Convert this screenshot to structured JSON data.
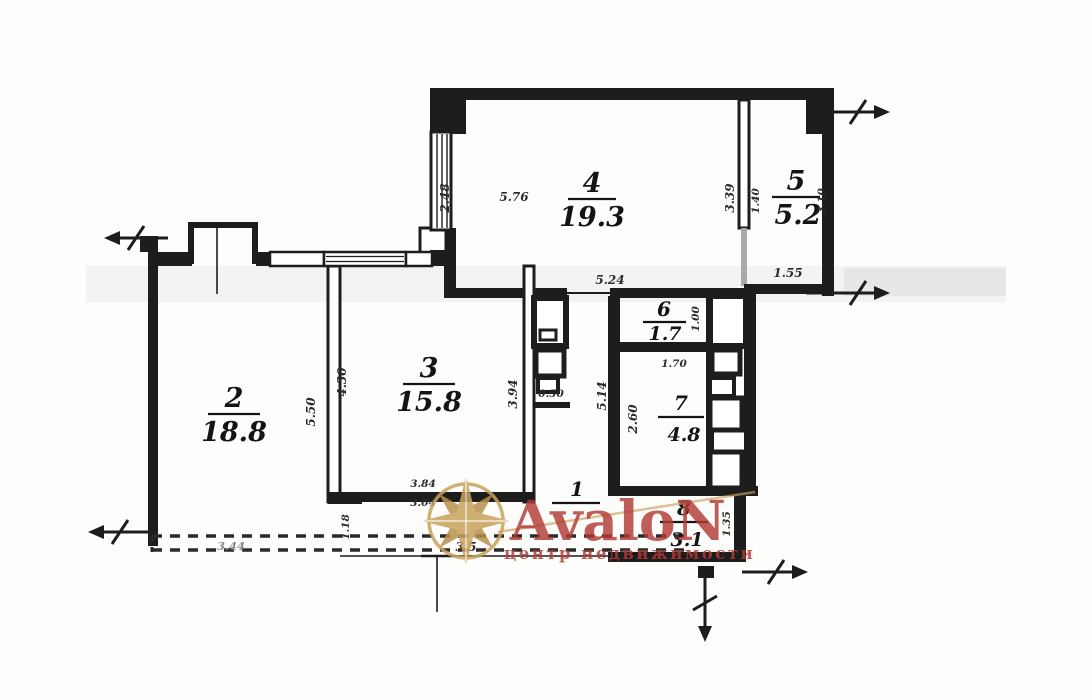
{
  "plan": {
    "rooms": [
      {
        "number": "1",
        "area": ""
      },
      {
        "number": "2",
        "area": "18.8"
      },
      {
        "number": "3",
        "area": "15.8"
      },
      {
        "number": "4",
        "area": "19.3"
      },
      {
        "number": "5",
        "area": "5.2"
      },
      {
        "number": "6",
        "area": "1.7"
      },
      {
        "number": "7",
        "area": "4.8"
      },
      {
        "number": "8",
        "area": "3.1"
      }
    ],
    "dimensions": [
      {
        "label": "5.76"
      },
      {
        "label": "2.48"
      },
      {
        "label": "3.39"
      },
      {
        "label": "1.40"
      },
      {
        "label": "3.10"
      },
      {
        "label": "5.24"
      },
      {
        "label": "1.55"
      },
      {
        "label": "5.50"
      },
      {
        "label": "4.30"
      },
      {
        "label": "3.94"
      },
      {
        "label": "0.50"
      },
      {
        "label": "5.14"
      },
      {
        "label": "1.00"
      },
      {
        "label": "1.70"
      },
      {
        "label": "2.60"
      },
      {
        "label": "3.84"
      },
      {
        "label": "3.04"
      },
      {
        "label": "1.18"
      },
      {
        "label": "3.44"
      },
      {
        "label": "3.5"
      },
      {
        "label": "1.35"
      }
    ],
    "watermark": {
      "brand": "AvaloN",
      "tagline": "центр недвижимости",
      "brand_color": "#b23b36",
      "star_color": "#c9a25c",
      "star_dark": "#b8914f"
    }
  }
}
